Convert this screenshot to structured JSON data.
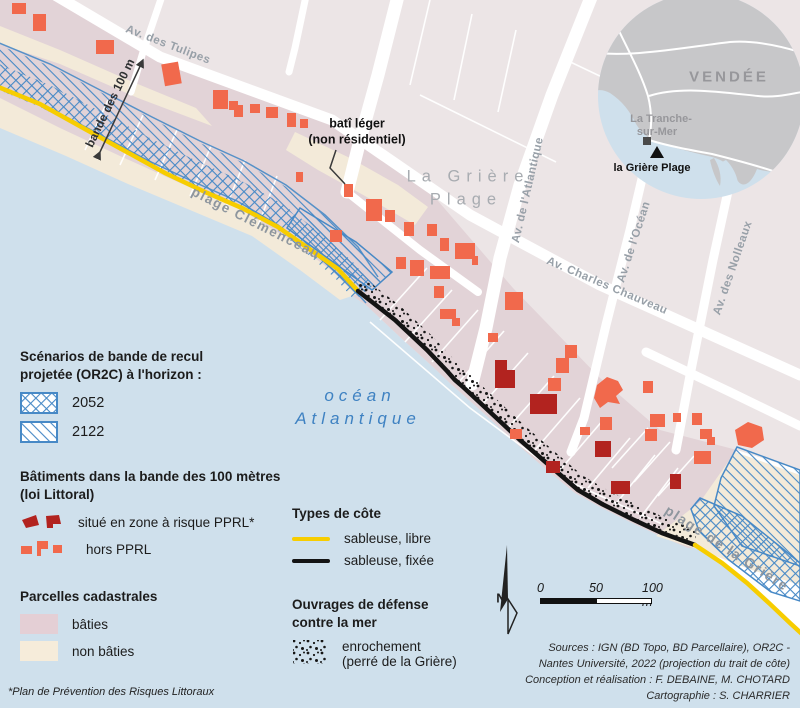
{
  "map": {
    "labels": {
      "av_tulipes": "Av. des Tulipes",
      "av_atlantique": "Av. de l'Atlantique",
      "av_chauveau": "Av. Charles Chauveau",
      "av_ocean": "Av. de l'Océan",
      "av_nolleaux": "Av. des Nolleaux",
      "quartier_1": "La Grière",
      "quartier_2": "Plage",
      "plage_clemenceau": "plage Clémenceau",
      "plage_griere": "plage de la Grière",
      "ocean_1": "océan",
      "ocean_2": "Atlantique",
      "bande_100m": "bande des 100 m",
      "bati_leger_1": "batî léger",
      "bati_leger_2": "(non résidentiel)",
      "north": "N"
    },
    "inset": {
      "region": "VENDÉE",
      "town_1": "La Tranche-",
      "town_2": "sur-Mer",
      "place": "la Grière Plage"
    }
  },
  "legend": {
    "scenarios": {
      "title_1": "Scénarios de bande de recul",
      "title_2": "projetée (OR2C) à l'horizon  :",
      "items": [
        {
          "label": "2052"
        },
        {
          "label": "2122"
        }
      ]
    },
    "batiments": {
      "title_1": "Bâtiments dans la bande des 100 mètres",
      "title_2": "(loi Littoral)",
      "items": [
        {
          "label": "situé en zone à risque PPRL*"
        },
        {
          "label": "hors PPRL"
        }
      ]
    },
    "parcelles": {
      "title": "Parcelles cadastrales",
      "items": [
        {
          "label": "bâties"
        },
        {
          "label": "non bâties"
        }
      ]
    },
    "footnote": "*Plan de Prévention des Risques Littoraux",
    "cotes": {
      "title": "Types de côte",
      "items": [
        {
          "label": "sableuse, libre"
        },
        {
          "label": "sableuse, fixée"
        }
      ]
    },
    "ouvrages": {
      "title_1": "Ouvrages de défense",
      "title_2": "contre la mer",
      "item_1": "enrochement",
      "item_2": "(perré de la Grière)"
    }
  },
  "scalebar": {
    "tick_0": "0",
    "tick_50": "50",
    "tick_100": "100 m"
  },
  "credits": {
    "line_1": "Sources : IGN (BD Topo, BD Parcellaire), OR2C -",
    "line_2": "Nantes Université, 2022 (projection du trait de côte)",
    "line_3": "Conception et réalisation : F. DEBAINE, M. CHOTARD",
    "line_4": "Cartographie : S. CHARRIER"
  },
  "colors": {
    "ocean": "#cfe0ec",
    "beach": "#ffffff",
    "parcel_base": "#ece5e6",
    "parcel_built": "#e2d3d7",
    "parcel_unbuilt": "#f3ead9",
    "building_hors_pprl": "#f1694c",
    "building_pprl": "#b2231f",
    "hatch_blue": "#4789c6",
    "coast_libre": "#f7cd00",
    "coast_fixee": "#141414",
    "street": "#ffffff",
    "street_label": "#98a0a8",
    "place_label": "#a8acb1",
    "beach_label": "#8e969e",
    "ocean_label": "#3f82c2",
    "inset_land": "#c7c7c9",
    "inset_sea": "#cfe0ec",
    "inset_label": "#97979b",
    "text": "#1c1c1c"
  }
}
